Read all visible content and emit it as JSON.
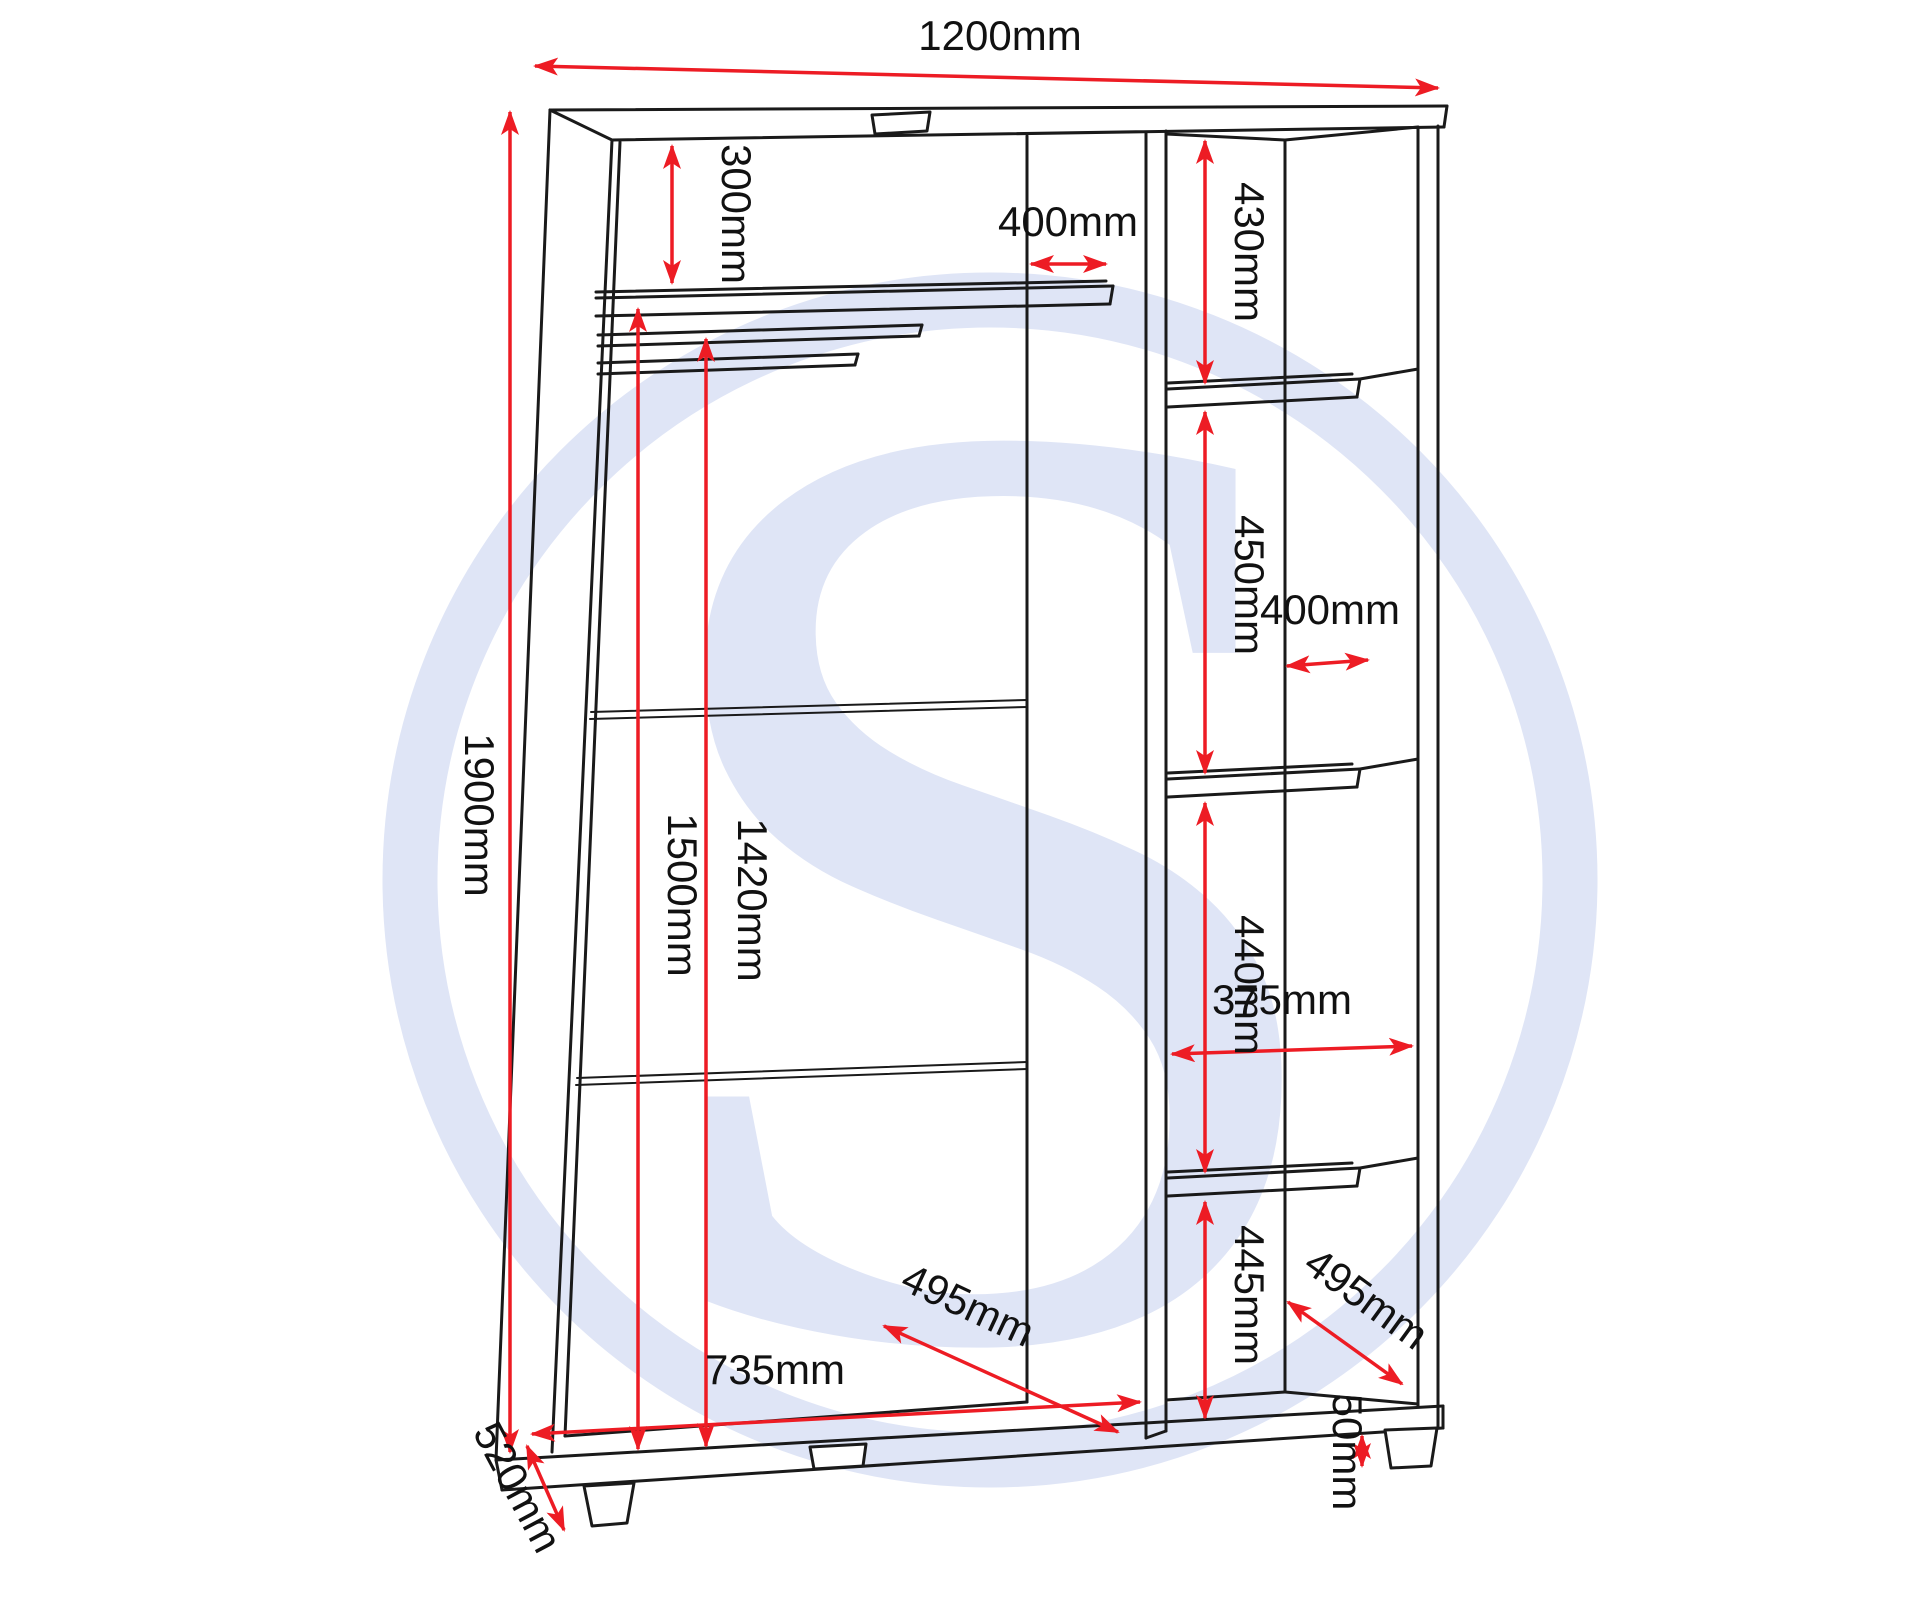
{
  "diagram": {
    "type": "furniture-dimension-drawing",
    "product": "3 door wardrobe carcass (open frame with shelves and hanging rails)",
    "units": "mm"
  },
  "colors": {
    "background": "#ffffff",
    "line": "#1a1a1a",
    "dimension": "#ed1c24",
    "watermark": "#dfe5f6"
  },
  "watermark": {
    "letter": "S"
  },
  "dims": {
    "width_top": {
      "label": "1200mm",
      "value": 1200
    },
    "height_left": {
      "label": "1900mm",
      "value": 1900
    },
    "top_shelf_gap": {
      "label": "300mm",
      "value": 300
    },
    "main_shelf_depth": {
      "label": "400mm",
      "value": 400
    },
    "hanging_drop_long": {
      "label": "1500mm",
      "value": 1500
    },
    "hanging_drop_short": {
      "label": "1420mm",
      "value": 1420
    },
    "right_top_section": {
      "label": "430mm",
      "value": 430
    },
    "right_second_section": {
      "label": "450mm",
      "value": 450
    },
    "right_shelf_depth": {
      "label": "400mm",
      "value": 400
    },
    "right_third_section": {
      "label": "440mm",
      "value": 440
    },
    "right_shelf_width": {
      "label": "375mm",
      "value": 375
    },
    "right_bottom_section": {
      "label": "445mm",
      "value": 445
    },
    "main_interior_depth": {
      "label": "495mm",
      "value": 495
    },
    "right_interior_depth": {
      "label": "495mm",
      "value": 495
    },
    "main_interior_width": {
      "label": "735mm",
      "value": 735
    },
    "side_depth": {
      "label": "520mm",
      "value": 520
    },
    "foot_height": {
      "label": "50mm",
      "value": 50
    }
  }
}
